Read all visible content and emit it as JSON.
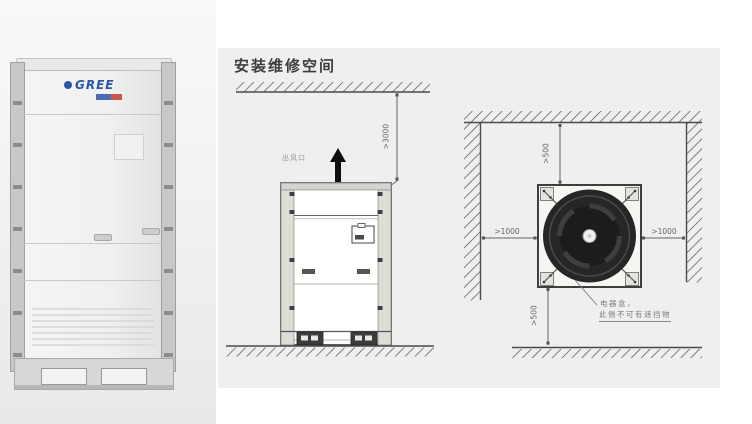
{
  "photo": {
    "brand": "GREE"
  },
  "diagram": {
    "title": "安装维修空间",
    "front_view": {
      "air_outlet_label": "出风口",
      "top_clearance": ">3000"
    },
    "top_view": {
      "rear_clearance": ">500",
      "front_clearance": ">500",
      "left_clearance": ">1000",
      "right_clearance": ">1000",
      "note_line1": "电器盒，",
      "note_line2": "此侧不可有遮挡物"
    }
  },
  "colors": {
    "panel_bg": "#eeefee",
    "line": "#4a4a4a",
    "fan_dark": "#232323",
    "logo_blue": "#2f55a5",
    "logo_red": "#c23b2d"
  }
}
